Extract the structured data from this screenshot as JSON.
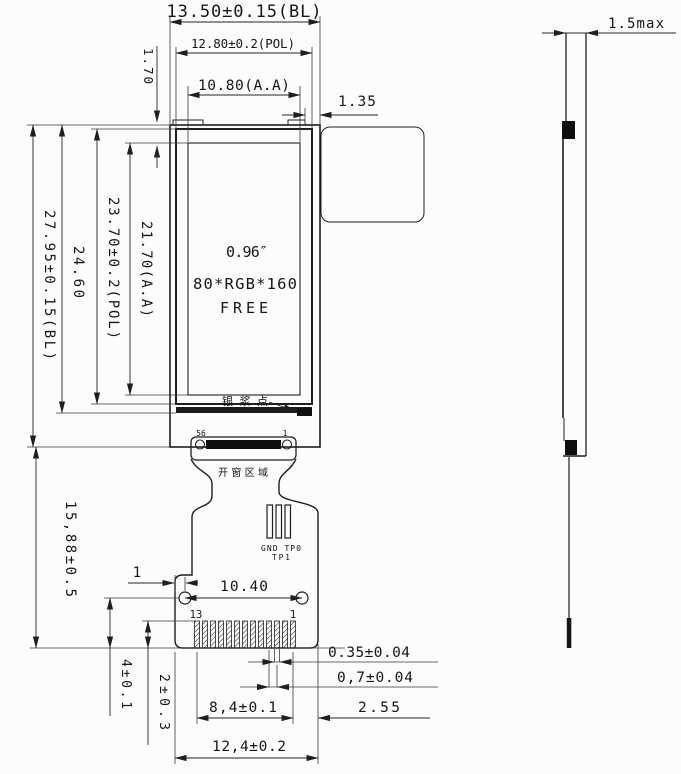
{
  "front_view": {
    "panel_text": {
      "size": "0.96″",
      "resolution": "80*RGB*160",
      "name": "FREE"
    },
    "annotations": {
      "silver_paste": "银浆点",
      "window_area": "开窗区域",
      "testpad_row1": "GND TP0",
      "testpad_row2": "TP1",
      "connector_left_pin": "56",
      "connector_right_pin": "1",
      "bottom_left_pin": "13",
      "bottom_right_pin": "1"
    },
    "dimensions": {
      "bl_width": "13.50±0.15(BL)",
      "pol_width": "12.80±0.2(POL)",
      "aa_width": "10.80(A.A)",
      "top_margin": "1.70",
      "tab_width": "1.35",
      "bl_height": "27.95±0.15(BL)",
      "glass_height": "24.60",
      "pol_height": "23.70±0.2(POL)",
      "aa_height": "21.70(A.A)",
      "fpc_length": "15,88±0.5",
      "hole_offset": "1",
      "hole_pitch": "10.40",
      "pin_row_offset": "4±0.1",
      "pin_length": "2±0.3",
      "pin_span": "8,4±0.1",
      "plate_width": "12,4±0.2",
      "pin_width": "0.35±0.04",
      "pin_pitch": "0,7±0.04",
      "edge_margin": "2.55"
    }
  },
  "side_view": {
    "dimensions": {
      "thickness": "1.5max"
    }
  },
  "colors": {
    "ink": "#1f1f1f",
    "background": "#fcfcfc"
  }
}
